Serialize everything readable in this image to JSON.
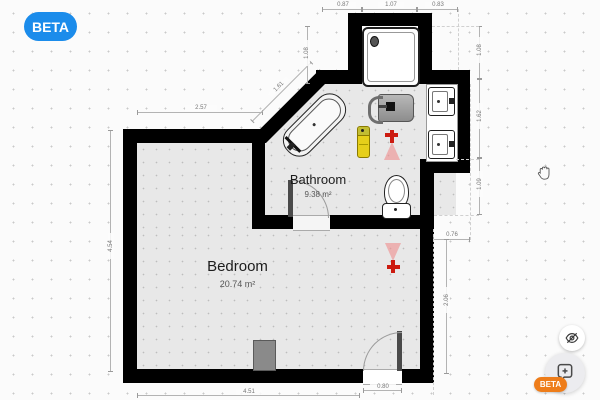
{
  "app": {
    "beta_badge": "BETA"
  },
  "plan": {
    "rooms": [
      {
        "name": "Bedroom",
        "area": "20.74 m²"
      },
      {
        "name": "Bathroom",
        "area": "9.38 m²"
      }
    ],
    "dimensions": {
      "top_left_width": "2.57",
      "left_height": "4.54",
      "diagonal": "1.61",
      "alcove_left": "1.08",
      "top_a": "0.87",
      "top_b": "1.07",
      "top_c": "0.83",
      "right_a": "1.08",
      "right_b": "1.62",
      "right_c": "1.09",
      "nook_width": "0.76",
      "right_lower": "2.06",
      "door_width": "0.80",
      "bottom_width": "4.51"
    },
    "fixtures": [
      "shower",
      "bathtub",
      "washing-machine",
      "sink",
      "sink",
      "toilet",
      "radiator",
      "leak-sensor",
      "sprinkler",
      "sprinkler",
      "door",
      "door"
    ]
  },
  "controls": {
    "visibility_button": "eye-off",
    "feedback_button": "chat-plus",
    "beta_badge": "BETA"
  },
  "colors": {
    "accent_blue": "#1b8ceb",
    "accent_orange": "#ee7d1a",
    "wall": "#000000",
    "floor": "#e8e8e8",
    "sprinkler_red": "#cc1b10",
    "sensor_yellow": "#e6cf1a"
  }
}
